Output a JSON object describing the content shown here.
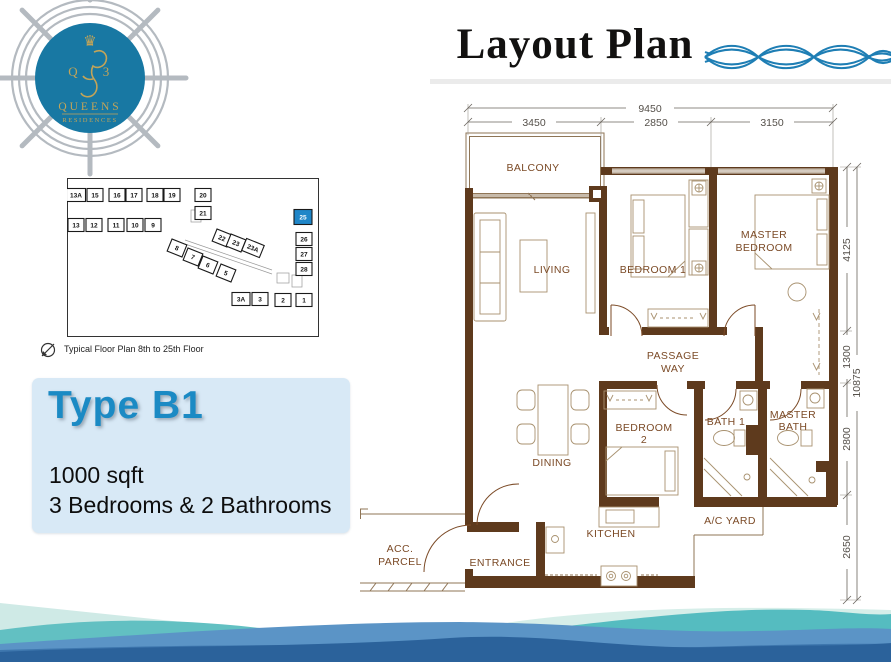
{
  "header": {
    "title": "Layout Plan"
  },
  "logo": {
    "q": "Q",
    "three": "3",
    "name_line1": "QUEENS",
    "name_line2": "RESIDENCES",
    "circle_color": "#1878a3",
    "gold_color": "#c3a458",
    "wheel_color": "#b4bac0"
  },
  "key_plan": {
    "caption": "Typical Floor Plan 8th to 25th Floor",
    "highlight_color": "#1f86c8",
    "units": [
      {
        "no": "13A",
        "x": 9,
        "y": 17,
        "w": 19
      },
      {
        "no": "15",
        "x": 28,
        "y": 17
      },
      {
        "no": "16",
        "x": 50,
        "y": 17
      },
      {
        "no": "17",
        "x": 67,
        "y": 17
      },
      {
        "no": "18",
        "x": 88,
        "y": 17
      },
      {
        "no": "19",
        "x": 105,
        "y": 17
      },
      {
        "no": "20",
        "x": 136,
        "y": 17
      },
      {
        "no": "21",
        "x": 136,
        "y": 35
      },
      {
        "no": "13",
        "x": 9,
        "y": 47
      },
      {
        "no": "12",
        "x": 27,
        "y": 47
      },
      {
        "no": "11",
        "x": 49,
        "y": 47
      },
      {
        "no": "10",
        "x": 68,
        "y": 47
      },
      {
        "no": "9",
        "x": 86,
        "y": 47
      },
      {
        "no": "8",
        "x": 110,
        "y": 70,
        "rot": 22
      },
      {
        "no": "7",
        "x": 126,
        "y": 79,
        "rot": 22
      },
      {
        "no": "6",
        "x": 141,
        "y": 87,
        "rot": 22
      },
      {
        "no": "5",
        "x": 159,
        "y": 95,
        "rot": 22
      },
      {
        "no": "22",
        "x": 155,
        "y": 60,
        "rot": 22
      },
      {
        "no": "23",
        "x": 169,
        "y": 65,
        "rot": 22
      },
      {
        "no": "23A",
        "x": 186,
        "y": 70,
        "rot": 22,
        "w": 19
      },
      {
        "no": "25",
        "x": 236,
        "y": 39,
        "w": 18,
        "h": 15,
        "highlight": true
      },
      {
        "no": "26",
        "x": 237,
        "y": 61
      },
      {
        "no": "27",
        "x": 237,
        "y": 76
      },
      {
        "no": "28",
        "x": 237,
        "y": 91
      },
      {
        "no": "3A",
        "x": 174,
        "y": 121,
        "w": 18
      },
      {
        "no": "3",
        "x": 193,
        "y": 121
      },
      {
        "no": "2",
        "x": 216,
        "y": 122
      },
      {
        "no": "1",
        "x": 237,
        "y": 122
      }
    ]
  },
  "type_panel": {
    "title": "Type B1",
    "area": "1000 sqft",
    "config": "3 Bedrooms & 2 Bathrooms",
    "accent_color": "#1b8ac4",
    "bg_color": "#d8e9f6"
  },
  "floor_plan": {
    "wall_color": "#5e3a1d",
    "label_color": "#7b4a26",
    "rooms": {
      "balcony": "BALCONY",
      "living": "LIVING",
      "bedroom1": "BEDROOM 1",
      "master_bedroom": [
        "MASTER",
        "BEDROOM"
      ],
      "passage": [
        "PASSAGE",
        "WAY"
      ],
      "dining": "DINING",
      "bedroom2": [
        "BEDROOM",
        "2"
      ],
      "bath1": "BATH 1",
      "master_bath": [
        "MASTER",
        "BATH"
      ],
      "ac_yard": "A/C YARD",
      "kitchen": "KITCHEN",
      "entrance": "ENTRANCE",
      "acc_parcel": [
        "ACC.",
        "PARCEL"
      ]
    },
    "dimensions": {
      "top_total": "9450",
      "top_segments": [
        "3450",
        "2850",
        "3150"
      ],
      "right_segments": [
        "4125",
        "1300",
        "2800",
        "2650"
      ],
      "right_total": "10875"
    }
  }
}
